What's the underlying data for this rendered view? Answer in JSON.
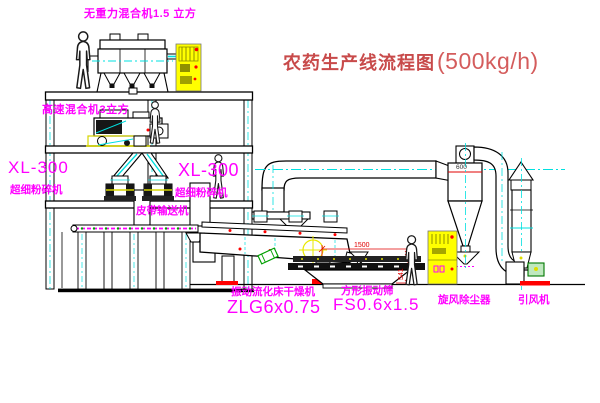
{
  "title": {
    "name": "农药生产线流程图",
    "capacity": "(500kg/h)"
  },
  "labels": {
    "gravity_mixer": "无重力混合机1.5 立方",
    "high_speed_mixer": "高速混合机3立方",
    "left_model": "XL-300",
    "left_machine": "超细粉碎机",
    "center_model": "XL-300",
    "center_machine": "超细粉碎机",
    "belt_conveyor": "皮带输送机",
    "dryer_name": "振动流化床干燥机",
    "dryer_model": "ZLG6x0.75",
    "screen_name": "方形振动筛",
    "screen_model": "FS0.6x1.5",
    "cyclone": "旋风除尘器",
    "fan": "引风机"
  },
  "dims": {
    "screen_length": "1500",
    "screen_height": "541",
    "cyclone_dia": "600"
  },
  "colors": {
    "label_magenta": "#ff00ff",
    "title_red": "#c84a4a",
    "centerline_cyan": "#00e0e0",
    "cabinet_yellow": "#ffff00",
    "alert_red": "#ff0000",
    "machine_green": "#00a000",
    "drawing_black": "#000000",
    "background": "#ffffff"
  }
}
